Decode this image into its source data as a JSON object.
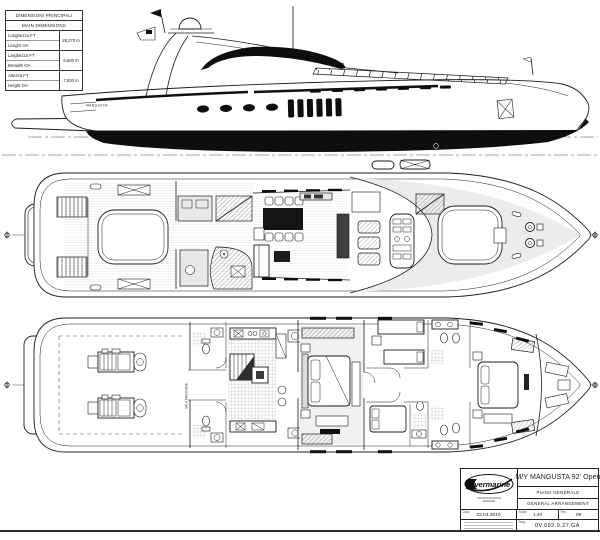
{
  "sheet": {
    "dimensions_table": {
      "title_it": "DIMENSIONI PRINCIPALI",
      "title_en": "MAIN DIMENSIONS",
      "rows": [
        {
          "label_it": "Lunghezza FT",
          "label_en": "Lenght OA",
          "value": "28,270 m"
        },
        {
          "label_it": "Larghezza FT",
          "label_en": "Breadth OA",
          "value": "6,600 m"
        },
        {
          "label_it": "Altezza FT",
          "label_en": "Height OA",
          "value": "7,530 m"
        }
      ]
    },
    "hull_brand_label": "MANGUSTA",
    "engine_room_label": "SALA MACCHINE",
    "title_block": {
      "logo_text": "overmarine",
      "project_name": "M/Y MANGUSTA 92' Open",
      "drawing_title_it": "PIANO GENERALE",
      "drawing_title_en": "GENERAL ARRANGEMENT",
      "date_label": "Data",
      "date_value": "02.04.2010",
      "scale_label": "Scala",
      "scale_value": "1:40",
      "rev_label": "Rev.",
      "rev_value": "09",
      "dwg_label": "Dwg.",
      "dwg_value": "0V.092.0.27.GA"
    }
  }
}
